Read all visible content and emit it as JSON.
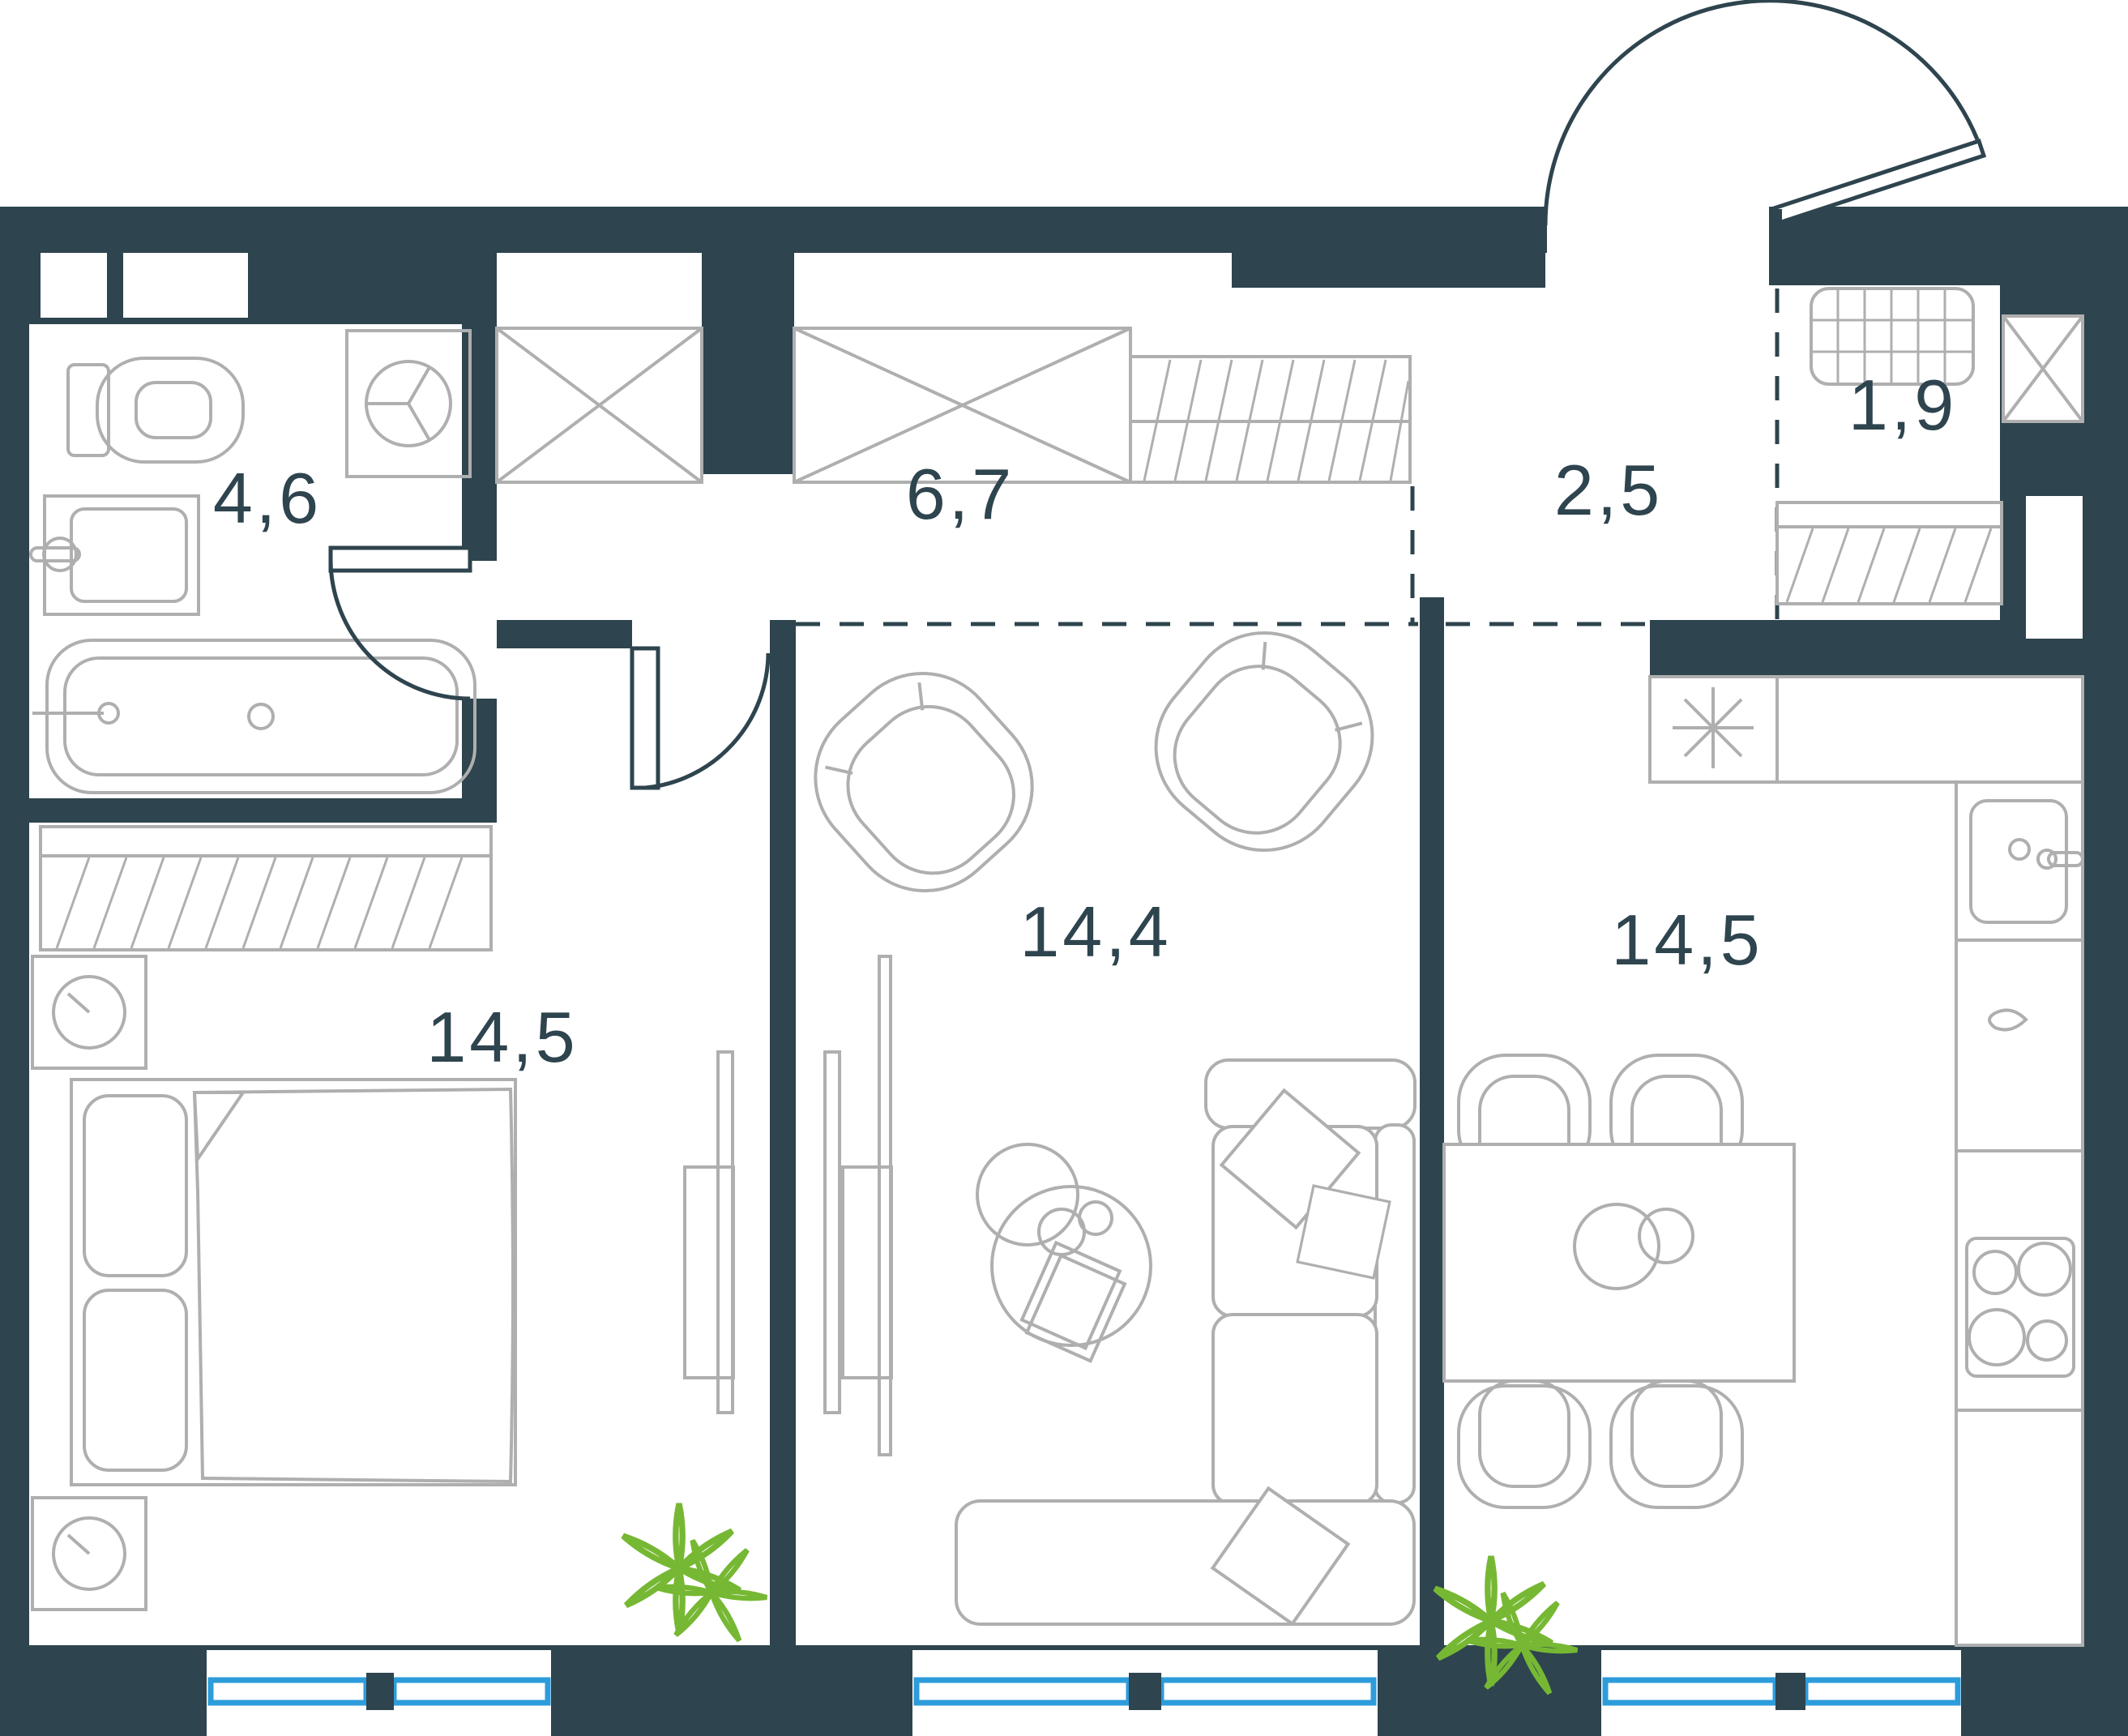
{
  "plan": {
    "type": "apartment-floor-plan",
    "rooms": [
      {
        "id": "bathroom",
        "area": "4,6"
      },
      {
        "id": "hallway",
        "area": "6,7"
      },
      {
        "id": "entry",
        "area": "2,5"
      },
      {
        "id": "wardrobe",
        "area": "1,9"
      },
      {
        "id": "bedroom",
        "area": "14,5"
      },
      {
        "id": "living-room",
        "area": "14,4"
      },
      {
        "id": "kitchen",
        "area": "14,5"
      }
    ],
    "colors": {
      "wall": "#2E444E",
      "furniture": "#AFAFAF",
      "window": "#2D9CDB",
      "plant": "#76B833",
      "label": "#2E444E",
      "bg": "#FFFFFF"
    }
  }
}
